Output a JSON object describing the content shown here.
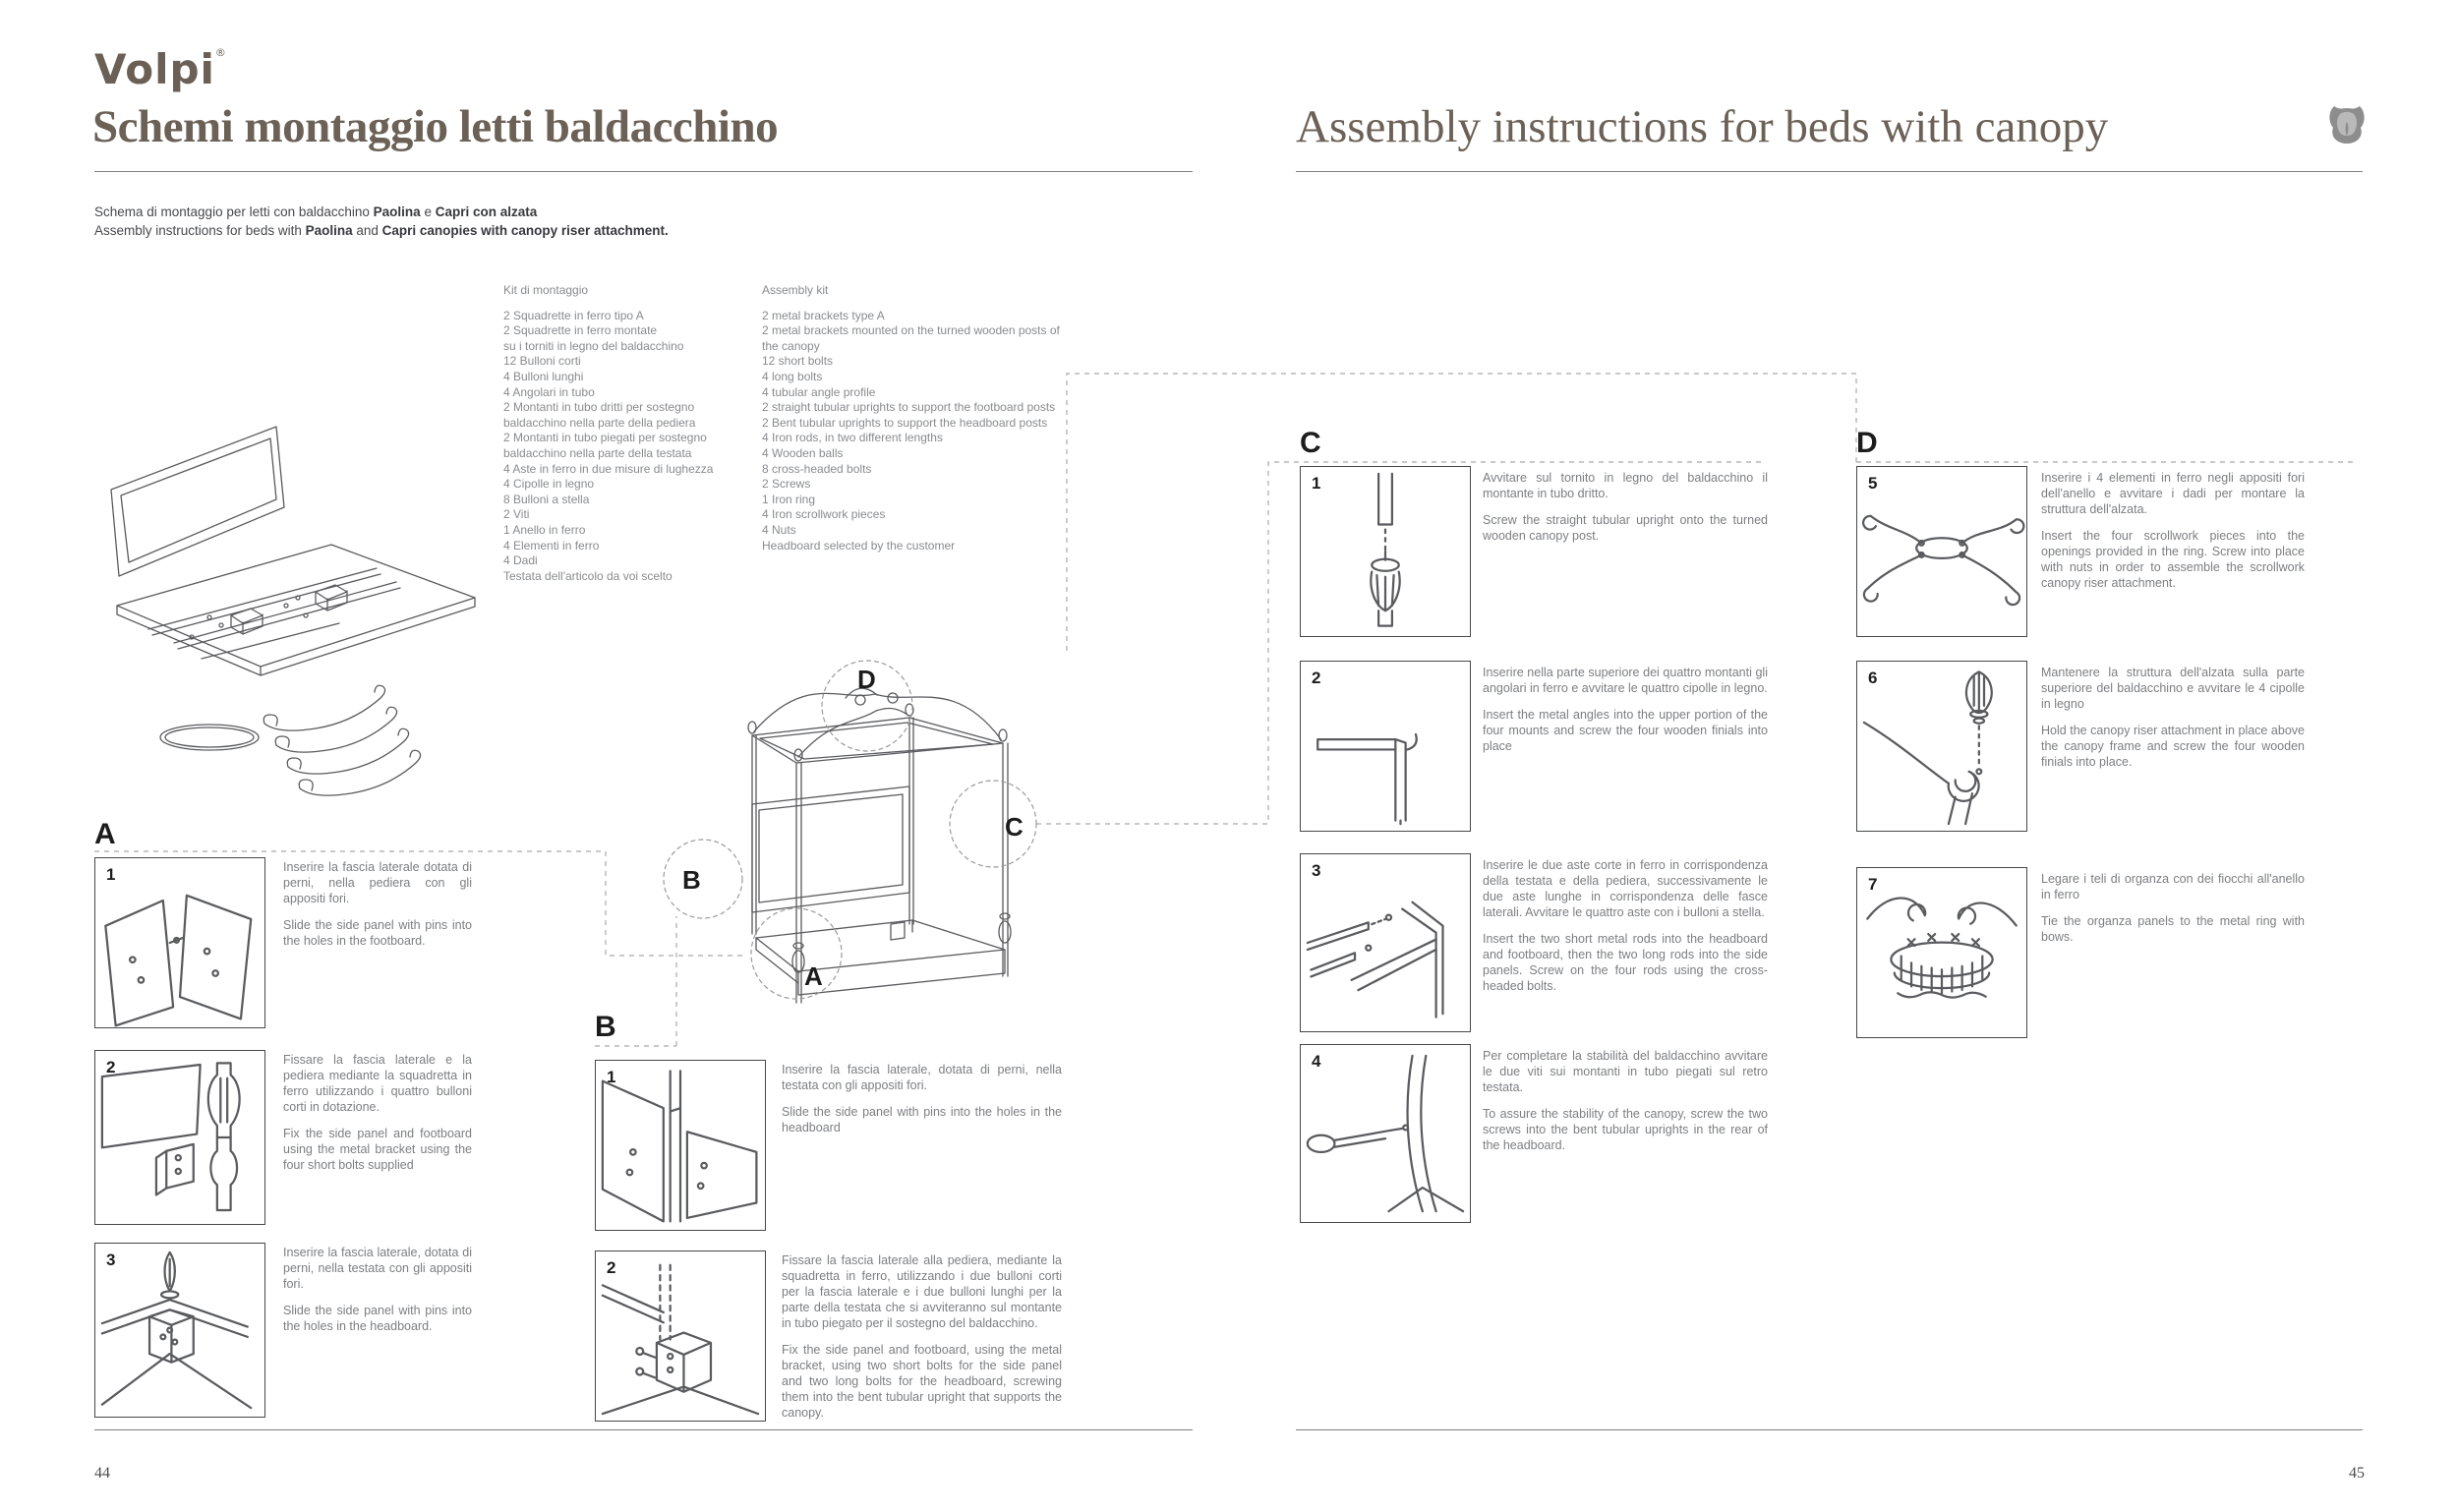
{
  "brand": {
    "logo": "Volpi",
    "mark": "®"
  },
  "left_page": {
    "title": "Schemi montaggio letti baldacchino",
    "subtitle_it": {
      "pre": "Schema di montaggio per letti con baldacchino ",
      "bold1": "Paolina",
      "mid": " e ",
      "bold2": "Capri con alzata"
    },
    "subtitle_en": {
      "pre": "Assembly instructions for beds with ",
      "bold1": "Paolina",
      "mid": " and ",
      "bold2": "Capri canopies with canopy riser attachment."
    },
    "kit_it": {
      "title": "Kit di montaggio",
      "items": [
        "2 Squadrette in ferro tipo A",
        "2 Squadrette in ferro montate",
        "su i torniti in legno del baldacchino",
        "12 Bulloni corti",
        "4 Bulloni lunghi",
        "4 Angolari in tubo",
        "2 Montanti in tubo dritti per sostegno",
        "baldacchino nella parte della pediera",
        "2 Montanti in tubo piegati per sostegno",
        "baldacchino nella parte della testata",
        "4 Aste in ferro in due misure di lughezza",
        "4 Cipolle in legno",
        "8 Bulloni a stella",
        "2 Viti",
        "1 Anello in ferro",
        "4 Elementi in ferro",
        "4 Dadi",
        "Testata dell'articolo da voi scelto"
      ]
    },
    "kit_en": {
      "title": "Assembly kit",
      "items": [
        "2 metal brackets type A",
        "2 metal brackets mounted on the turned wooden posts of",
        "the canopy",
        "12 short bolts",
        "4 long bolts",
        "4 tubular angle profile",
        "2 straight tubular uprights to support the footboard posts",
        "2 Bent tubular uprights to support the headboard posts",
        "4 Iron rods, in two different lengths",
        "4 Wooden balls",
        "8 cross-headed bolts",
        "2 Screws",
        "1 Iron ring",
        "4 Iron scrollwork pieces",
        "4 Nuts",
        "Headboard selected by the customer"
      ]
    },
    "sections": {
      "A": {
        "label": "A",
        "steps": [
          {
            "num": "1",
            "it": "Inserire la fascia laterale dotata di perni, nella pediera con gli appositi fori.",
            "en": "Slide the side panel with pins into the holes in the footboard."
          },
          {
            "num": "2",
            "it": "Fissare la fascia laterale e la pediera mediante la squadretta in ferro utilizzando i quattro bulloni corti in dotazione.",
            "en": "Fix the side panel and footboard using the metal bracket using the four short bolts supplied"
          },
          {
            "num": "3",
            "it": "Inserire la fascia laterale, dotata di perni, nella testata con gli appositi fori.",
            "en": "Slide the side panel with pins into the holes in the headboard."
          }
        ]
      },
      "B": {
        "label": "B",
        "steps": [
          {
            "num": "1",
            "it": "Inserire la fascia laterale, dotata di perni, nella testata con gli appositi fori.",
            "en": "Slide the side panel with pins into the holes in the headboard"
          },
          {
            "num": "2",
            "it": "Fissare la fascia laterale alla pediera, mediante la squadretta in ferro, utilizzando i due bulloni corti per la fascia laterale e i due bulloni lunghi per la parte della testata che si avviteranno sul montante in tubo piegato per il sostegno del baldacchino.",
            "en": "Fix the side panel and footboard, using the metal bracket, using two short bolts for the side panel and two long bolts for the headboard, screwing them into the bent tubular upright that supports the canopy."
          }
        ]
      }
    },
    "page_number": "44"
  },
  "right_page": {
    "title": "Assembly instructions for beds with canopy",
    "sections": {
      "C": {
        "label": "C",
        "steps": [
          {
            "num": "1",
            "it": "Avvitare sul tornito in legno del baldacchino il montante in tubo dritto.",
            "en": "Screw the straight tubular upright onto the turned wooden canopy post."
          },
          {
            "num": "2",
            "it": "Inserire nella parte superiore dei quattro montanti gli angolari in ferro e avvitare le quattro cipolle in legno.",
            "en": "Insert the metal angles into the upper portion of the four mounts and screw the four wooden finials into place"
          },
          {
            "num": "3",
            "it": "Inserire le due aste corte in ferro in corrispondenza della testata e della pediera, successivamente le due aste lunghe in corrispondenza delle fasce laterali. Avvitare le quattro aste con i bulloni a stella.",
            "en": "Insert the two short metal rods into the headboard and footboard, then the two long rods into the side panels. Screw on the four rods using the cross-headed bolts."
          },
          {
            "num": "4",
            "it": "Per completare la stabilità del baldacchino avvitare le due viti sui montanti in tubo piegati sul retro testata.",
            "en": "To assure the stability of the canopy, screw the two screws into the bent tubular uprights in the rear of the headboard."
          }
        ]
      },
      "D": {
        "label": "D",
        "steps": [
          {
            "num": "5",
            "it": "Inserire i 4 elementi in ferro negli appositi fori dell'anello e avvitare i dadi per montare la struttura dell'alzata.",
            "en": "Insert the four scrollwork pieces into the openings provided in the ring. Screw into place with nuts in order to assemble the scrollwork canopy riser attachment."
          },
          {
            "num": "6",
            "it": "Mantenere la struttura dell'alzata sulla parte superiore del baldacchino e avvitare le 4 cipolle in legno",
            "en": "Hold the canopy riser attachment in place above the canopy frame and screw the four wooden finials into place."
          },
          {
            "num": "7",
            "it": "Legare i teli di organza con dei fiocchi all'anello in ferro",
            "en": "Tie the organza panels to the metal ring with bows."
          }
        ]
      }
    },
    "page_number": "45"
  },
  "bed_labels": {
    "a": "A",
    "b": "B",
    "c": "C",
    "d": "D"
  },
  "colors": {
    "brand": "#6b6055",
    "body_text": "#7c7e81",
    "dark": "#1c1c1c",
    "rule": "#7f7f7f",
    "dashed": "#a9a9a9"
  }
}
